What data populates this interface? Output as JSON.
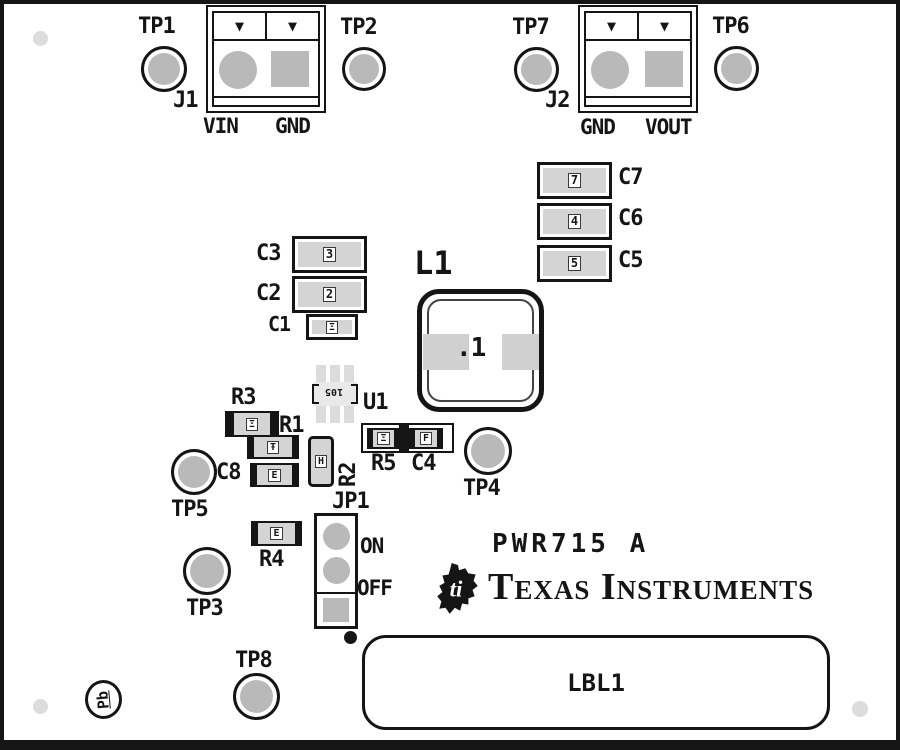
{
  "board_id": "PWR715 A",
  "brand": "Texas Instruments",
  "pb_free_mark": "Pb",
  "label_area": "LBL1",
  "connectors": {
    "j1": {
      "ref": "J1",
      "pin_left": "VIN",
      "pin_right": "GND"
    },
    "j2": {
      "ref": "J2",
      "pin_left": "GND",
      "pin_right": "VOUT"
    }
  },
  "jumper": {
    "ref": "JP1",
    "on": "ON",
    "off": "OFF"
  },
  "test_points": {
    "tp1": "TP1",
    "tp2": "TP2",
    "tp3": "TP3",
    "tp4": "TP4",
    "tp5": "TP5",
    "tp6": "TP6",
    "tp7": "TP7",
    "tp8": "TP8"
  },
  "components": {
    "c1": "C1",
    "c2": "C2",
    "c3": "C3",
    "c4": "C4",
    "c5": "C5",
    "c6": "C6",
    "c7": "C7",
    "c8": "C8",
    "r1": "R1",
    "r2": "R2",
    "r3": "R3",
    "r4": "R4",
    "r5": "R5",
    "u1": "U1",
    "l1": "L1"
  },
  "markings": {
    "l1": ".1",
    "u1": "105",
    "c7": "7",
    "c6": "4",
    "c5": "5",
    "c3": "3",
    "c2": "2",
    "c1": "Ξ",
    "r3": "Ξ",
    "r1": "Ŧ",
    "c8": "E",
    "r2": "H",
    "r4": "E",
    "r5": "Ξ",
    "c4": "F"
  },
  "icons": {
    "pin1_arrow": "▼"
  },
  "colors": {
    "silkscreen": "#151515",
    "pad_gray": "#b9b9b9",
    "body_gray": "#d4d4d4",
    "faint_gray": "#dcdcdc",
    "background": "#ffffff"
  }
}
